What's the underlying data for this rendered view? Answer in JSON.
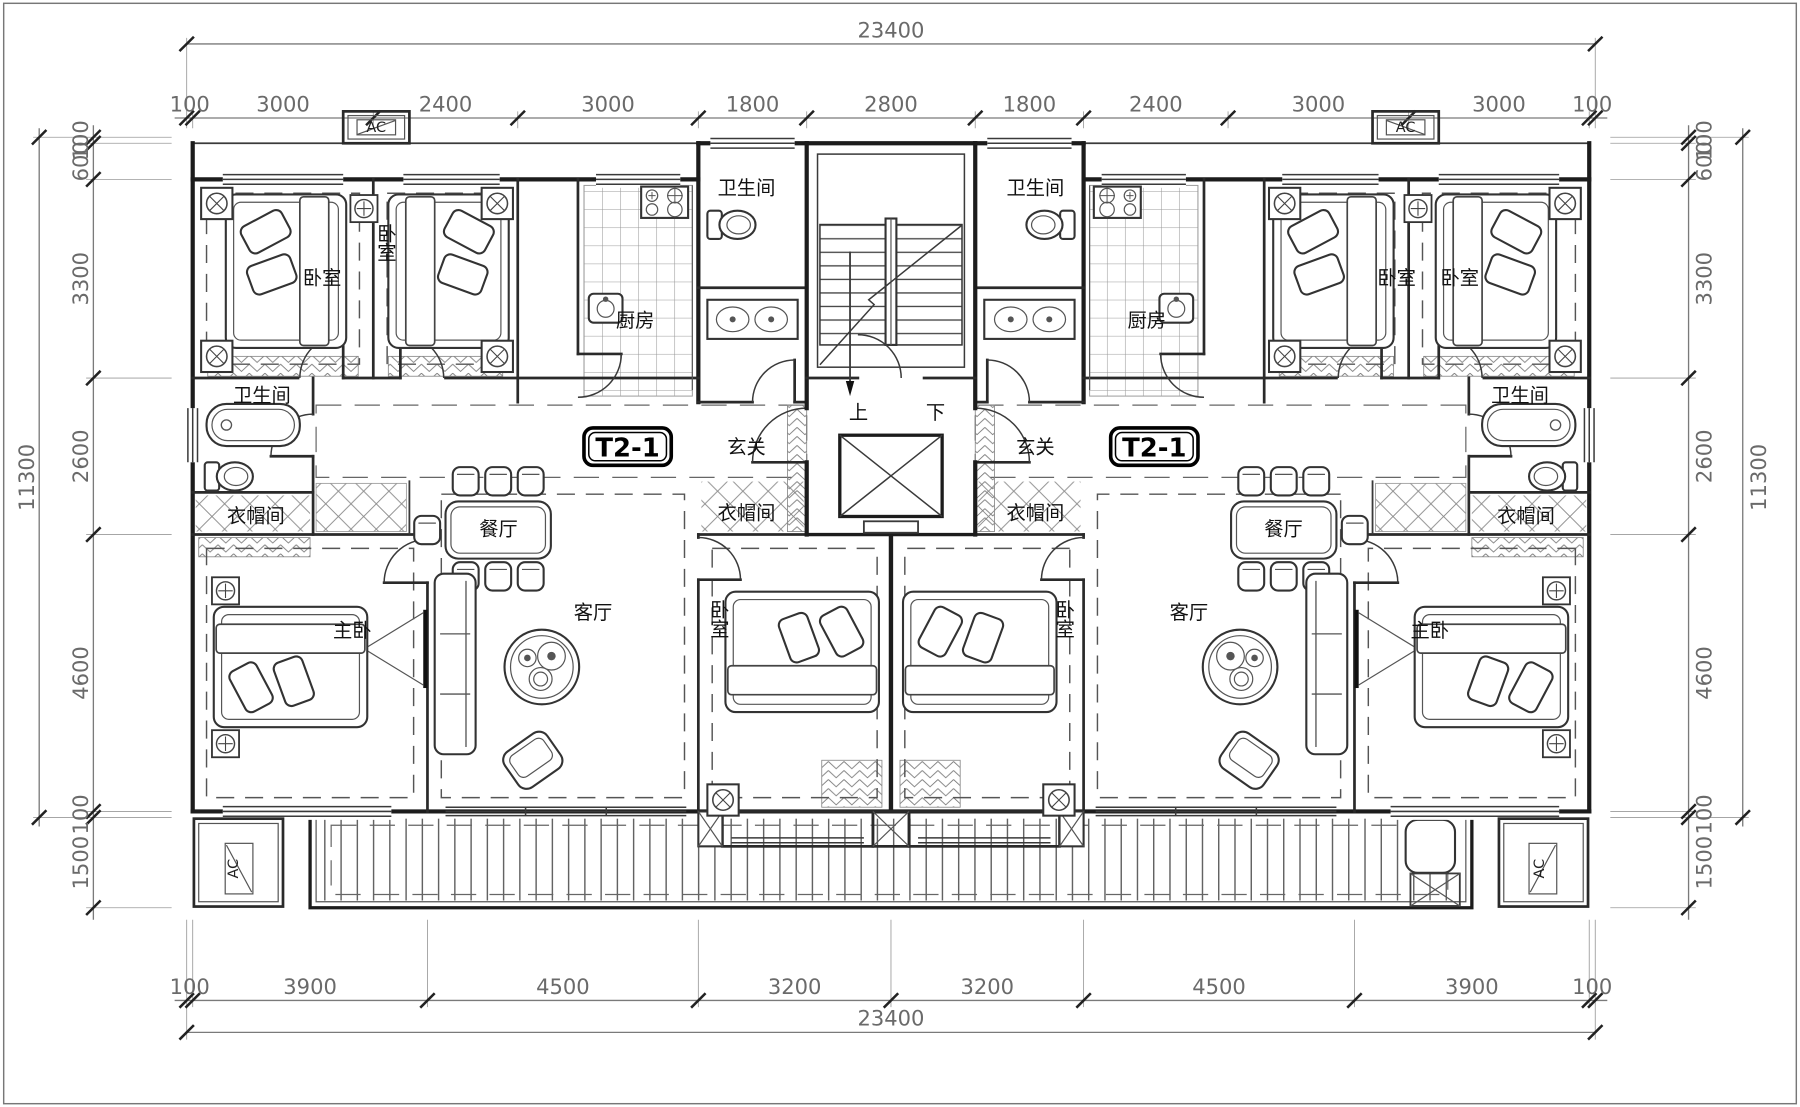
{
  "drawing": {
    "unit_tag": "T2-1"
  },
  "labels": {
    "bedroom": "卧室",
    "master_bedroom": "主卧",
    "living_room": "客厅",
    "dining_room": "餐厅",
    "kitchen": "厨房",
    "bathroom": "卫生间",
    "entry_hall": "玄关",
    "cloakroom": "衣帽间",
    "stair_up": "上",
    "stair_down": "下",
    "ac": "AC"
  },
  "dimensions": {
    "top_total": "23400",
    "top": [
      "100",
      "3000",
      "2400",
      "3000",
      "1800",
      "2800",
      "1800",
      "2400",
      "3000",
      "3000",
      "100"
    ],
    "bottom_total": "23400",
    "bottom": [
      "100",
      "3900",
      "4500",
      "3200",
      "3200",
      "4500",
      "3900",
      "100"
    ],
    "left_total": "11300",
    "left": [
      "100",
      "600",
      "3300",
      "2600",
      "4600",
      "100",
      "1500"
    ],
    "right_total": "11300",
    "right": [
      "100",
      "600",
      "3300",
      "2600",
      "4600",
      "100",
      "1500"
    ]
  },
  "colors": {
    "background": "#ffffff",
    "walls": "#1c1c1c",
    "dimension_text": "#6a6a6a",
    "label_text": "#111111"
  }
}
